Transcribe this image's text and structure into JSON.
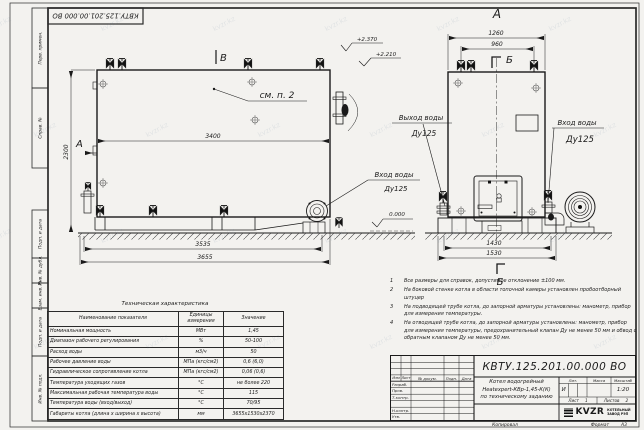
{
  "watermark": {
    "text": "kvzr.kz"
  },
  "frame": {
    "doc_number_rotated": "КВТУ.125.201.00.000 ВО",
    "stamp_columns": [
      "Перв. примен.",
      "Справ. №",
      "Подп. и дата",
      "Инв. № дубл.",
      "Взам. инв. №",
      "Подп. и дата",
      "Инв. № подл."
    ],
    "footer": {
      "kopiroval": "Копировал",
      "format_label": "Формат",
      "format_value": "А3"
    }
  },
  "side_view": {
    "section_label_a": "А",
    "section_label_b": "В",
    "callout": "см. п. 2",
    "dims": {
      "width_top": "3400",
      "height": "2300",
      "base": "3535",
      "overall": "3655"
    },
    "levels": {
      "top": "+2.370",
      "nozzle": "+2.210",
      "ground": "0.000"
    },
    "inlet": {
      "line1": "Вход воды",
      "line2": "Ду125"
    }
  },
  "front_view": {
    "view_label": "А",
    "section_b_top": "Б",
    "section_b_bottom": "Б",
    "dims": {
      "width_top": "1260",
      "valves": "960",
      "base": "1430",
      "overall": "1530"
    },
    "outlet": {
      "line1": "Выход воды",
      "line2": "Ду125"
    },
    "inlet": {
      "line1": "Вход воды",
      "line2": "Ду125"
    }
  },
  "notes": {
    "items": [
      {
        "num": "1",
        "text": "Все размеры для справок, допустимое отклонение ±100 мм."
      },
      {
        "num": "2",
        "text": "На боковой стенке котла в области топочной камеры установлен пробоотборный штуцер"
      },
      {
        "num": "3",
        "text": "На подводящей трубе котла, до запорной арматуры установлены: манометр, прибор для измерения температуры."
      },
      {
        "num": "4",
        "text": "На отводящей трубе котла, до запорной арматуры установлены: манометр, прибор для измерения температуры, предохранительный клапан Ду не менее 50 мм и обвод с обратным клапаном Ду не менее 50 мм."
      }
    ]
  },
  "spec_table": {
    "title": "Техническая характеристика",
    "headers": [
      "Наименование показателя",
      "Единицы измерения",
      "Значение"
    ],
    "rows": [
      {
        "name": "Номинальная мощность",
        "unit": "МВт",
        "value": "1,45"
      },
      {
        "name": "Диапазон рабочего регулирования",
        "unit": "%",
        "value": "50-100"
      },
      {
        "name": "Расход воды",
        "unit": "м3/ч",
        "value": "50"
      },
      {
        "name": "Рабочее давление воды",
        "unit": "МПа (кгс/см2)",
        "value": "0,6 (6,0)"
      },
      {
        "name": "Гидравлическое сопротивление котла",
        "unit": "МПа (кгс/см2)",
        "value": "0,06 (0,6)"
      },
      {
        "name": "Температура уходящих газов",
        "unit": "°С",
        "value": "не более 220"
      },
      {
        "name": "Максимальная рабочая температура воды",
        "unit": "°С",
        "value": "115"
      },
      {
        "name": "Температура воды (вход/выход)",
        "unit": "°С",
        "value": "70/95"
      },
      {
        "name": "Габариты котла (длина х ширина х высота)",
        "unit": "мм",
        "value": "3655х1530х2370"
      }
    ]
  },
  "title_block": {
    "doc_number": "КВТУ.125.201.00.000  ВО",
    "rev_header": [
      "Изм",
      "Лист",
      "№ докум.",
      "Подп.",
      "Дата"
    ],
    "roles": [
      "Разраб.",
      "Пров.",
      "Т.контр.",
      "",
      "Н.контр.",
      "Утв."
    ],
    "name_lines": [
      "Котел водогрейный",
      "Heatexpert-КВр-1,45-К(К)",
      "по техническому заданию"
    ],
    "lit_header": [
      "Лит.",
      "Масса",
      "Масштаб"
    ],
    "lit_value": "И",
    "scale": "1:20",
    "sheet_label": "Лист",
    "sheet_value": "1",
    "sheets_label": "Листов",
    "sheets_value": "2",
    "logo_text": "KVZR",
    "company_line1": "КОТЕЛЬНЫЙ",
    "company_line2": "ЗАВОД РЭП"
  }
}
